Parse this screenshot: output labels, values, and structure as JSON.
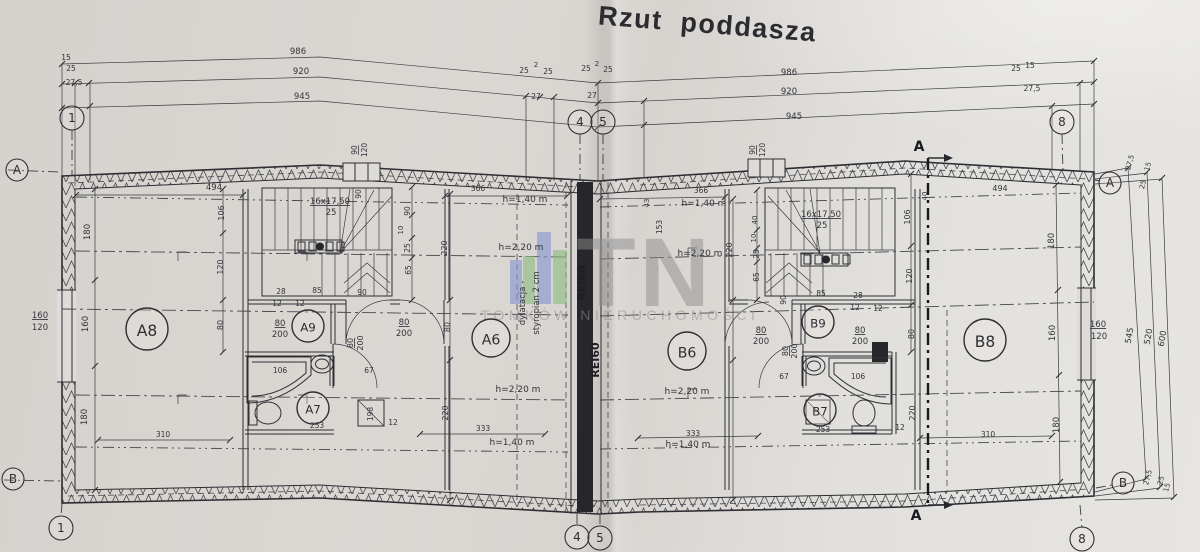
{
  "title": "Rzut poddasza",
  "watermark": {
    "brand": "TN",
    "subtitle": "TOMKÓW NIERUCHOMOŚCI",
    "color": "#8f8f8f",
    "bars": [
      {
        "x": 510,
        "y": 260,
        "w": 12,
        "h": 44,
        "c": "#8494ce"
      },
      {
        "x": 523,
        "y": 256,
        "w": 12,
        "h": 48,
        "c": "#8cbc80"
      },
      {
        "x": 537,
        "y": 232,
        "w": 14,
        "h": 72,
        "c": "#8494ce"
      },
      {
        "x": 553,
        "y": 250,
        "w": 14,
        "h": 54,
        "c": "#8cbc80"
      }
    ]
  },
  "rooms": [
    {
      "label": "A8",
      "x": 147,
      "y": 329,
      "r": 21
    },
    {
      "label": "A9",
      "x": 308,
      "y": 326,
      "r": 16
    },
    {
      "label": "A7",
      "x": 313,
      "y": 408,
      "r": 16
    },
    {
      "label": "A6",
      "x": 491,
      "y": 338,
      "r": 19
    },
    {
      "label": "B6",
      "x": 687,
      "y": 351,
      "r": 19
    },
    {
      "label": "B9",
      "x": 818,
      "y": 322,
      "r": 16
    },
    {
      "label": "B7",
      "x": 820,
      "y": 410,
      "r": 16
    },
    {
      "label": "B8",
      "x": 985,
      "y": 340,
      "r": 21
    }
  ],
  "axis_markers": [
    {
      "label": "1",
      "x": 72,
      "y": 118,
      "r": 12
    },
    {
      "label": "4",
      "x": 580,
      "y": 122,
      "r": 12
    },
    {
      "label": "5",
      "x": 603,
      "y": 122,
      "r": 12
    },
    {
      "label": "8",
      "x": 1062,
      "y": 122,
      "r": 12
    },
    {
      "label": "1",
      "x": 61,
      "y": 528,
      "r": 12
    },
    {
      "label": "4",
      "x": 577,
      "y": 537,
      "r": 12
    },
    {
      "label": "5",
      "x": 600,
      "y": 538,
      "r": 12
    },
    {
      "label": "8",
      "x": 1082,
      "y": 539,
      "r": 12
    },
    {
      "label": "A",
      "x": 17,
      "y": 170,
      "r": 11
    },
    {
      "label": "B",
      "x": 13,
      "y": 479,
      "r": 11
    },
    {
      "label": "A",
      "x": 1110,
      "y": 183,
      "r": 11
    },
    {
      "label": "B",
      "x": 1123,
      "y": 483,
      "r": 11
    }
  ],
  "section_markers": [
    {
      "label": "A",
      "x": 919,
      "y": 151
    },
    {
      "label": "A",
      "x": 916,
      "y": 520
    }
  ],
  "annotations": [
    {
      "t": "986",
      "x": 298,
      "y": 54
    },
    {
      "t": "15",
      "x": 66,
      "y": 60,
      "s": 7.5
    },
    {
      "t": "25",
      "x": 71,
      "y": 71,
      "s": 7.5
    },
    {
      "t": "920",
      "x": 301,
      "y": 74
    },
    {
      "t": "25",
      "x": 524,
      "y": 73,
      "s": 7.5
    },
    {
      "t": "2",
      "x": 536,
      "y": 67,
      "s": 7
    },
    {
      "t": "25",
      "x": 548,
      "y": 74,
      "s": 7.5
    },
    {
      "t": "27,5",
      "x": 74,
      "y": 85,
      "s": 7.5
    },
    {
      "t": "945",
      "x": 302,
      "y": 99
    },
    {
      "t": "27",
      "x": 536,
      "y": 99,
      "s": 7.5
    },
    {
      "t": "25",
      "x": 586,
      "y": 71,
      "s": 7.5
    },
    {
      "t": "2",
      "x": 597,
      "y": 66,
      "s": 7
    },
    {
      "t": "25",
      "x": 608,
      "y": 72,
      "s": 7.5
    },
    {
      "t": "27",
      "x": 592,
      "y": 98,
      "s": 7.5
    },
    {
      "t": "986",
      "x": 789,
      "y": 75
    },
    {
      "t": "920",
      "x": 789,
      "y": 94
    },
    {
      "t": "945",
      "x": 794,
      "y": 119
    },
    {
      "t": "25",
      "x": 1016,
      "y": 71,
      "s": 7.5
    },
    {
      "t": "15",
      "x": 1030,
      "y": 68,
      "s": 7.5
    },
    {
      "t": "27,5",
      "x": 1032,
      "y": 91,
      "s": 7.5
    },
    {
      "t": "160",
      "x": 40,
      "y": 318,
      "s": 8.5,
      "u": 1
    },
    {
      "t": "120",
      "x": 40,
      "y": 330,
      "s": 8.5
    },
    {
      "t": "180",
      "x": 90,
      "y": 232,
      "r": -90
    },
    {
      "t": "160",
      "x": 88,
      "y": 324,
      "r": -90
    },
    {
      "t": "180",
      "x": 87,
      "y": 417,
      "r": -90
    },
    {
      "t": "494",
      "x": 214,
      "y": 190
    },
    {
      "t": "106",
      "x": 224,
      "y": 213,
      "r": -90,
      "s": 8
    },
    {
      "t": "120",
      "x": 223,
      "y": 267,
      "r": -90,
      "s": 8
    },
    {
      "t": "80",
      "x": 223,
      "y": 325,
      "r": -90,
      "s": 8
    },
    {
      "t": "16x17,50",
      "x": 330,
      "y": 204,
      "s": 8.5,
      "u": 1
    },
    {
      "t": "25",
      "x": 331,
      "y": 215,
      "s": 8.5
    },
    {
      "t": "90",
      "x": 357,
      "y": 150,
      "r": -90,
      "s": 7.5,
      "u": 1
    },
    {
      "t": "120",
      "x": 367,
      "y": 150,
      "r": -90,
      "s": 7.5
    },
    {
      "t": "90",
      "x": 361,
      "y": 194,
      "r": -90,
      "s": 7.5
    },
    {
      "t": "90",
      "x": 410,
      "y": 211,
      "r": -90,
      "s": 7.5
    },
    {
      "t": "10",
      "x": 403,
      "y": 230,
      "r": -90,
      "s": 7
    },
    {
      "t": "25",
      "x": 410,
      "y": 248,
      "r": -90,
      "s": 7.5
    },
    {
      "t": "65",
      "x": 411,
      "y": 270,
      "r": -90,
      "s": 7.5
    },
    {
      "t": "220",
      "x": 447,
      "y": 248,
      "r": -90,
      "s": 8
    },
    {
      "t": "28",
      "x": 281,
      "y": 294,
      "s": 7.5
    },
    {
      "t": "85",
      "x": 317,
      "y": 293,
      "s": 7.5
    },
    {
      "t": "90",
      "x": 362,
      "y": 295,
      "s": 7.5
    },
    {
      "t": "12",
      "x": 277,
      "y": 306,
      "s": 7.5
    },
    {
      "t": "12",
      "x": 300,
      "y": 306,
      "s": 7.5
    },
    {
      "t": "80",
      "x": 280,
      "y": 326,
      "s": 8.5,
      "u": 1
    },
    {
      "t": "200",
      "x": 280,
      "y": 337,
      "s": 8.5
    },
    {
      "t": "80",
      "x": 404,
      "y": 325,
      "s": 8.5,
      "u": 1
    },
    {
      "t": "200",
      "x": 404,
      "y": 336,
      "s": 8.5
    },
    {
      "t": "80",
      "x": 353,
      "y": 343,
      "r": -90,
      "s": 8,
      "u": 1
    },
    {
      "t": "200",
      "x": 363,
      "y": 343,
      "r": -90,
      "s": 8
    },
    {
      "t": "106",
      "x": 280,
      "y": 373,
      "s": 7.5
    },
    {
      "t": "67",
      "x": 369,
      "y": 373,
      "s": 7.5
    },
    {
      "t": "253",
      "x": 317,
      "y": 428,
      "s": 7.5
    },
    {
      "t": "198",
      "x": 373,
      "y": 414,
      "r": -90,
      "s": 7.5
    },
    {
      "t": "12",
      "x": 393,
      "y": 425,
      "s": 7.5
    },
    {
      "t": "220",
      "x": 448,
      "y": 413,
      "r": -90,
      "s": 8
    },
    {
      "t": "310",
      "x": 163,
      "y": 437,
      "s": 7.5
    },
    {
      "t": "366",
      "x": 478,
      "y": 191,
      "s": 7.5
    },
    {
      "t": "h=1,40 m",
      "x": 525,
      "y": 202,
      "s": 9
    },
    {
      "t": "h=2,20 m",
      "x": 521,
      "y": 250,
      "s": 9
    },
    {
      "t": "80",
      "x": 450,
      "y": 327,
      "r": -90,
      "s": 8
    },
    {
      "t": "h=2,20 m",
      "x": 518,
      "y": 392,
      "s": 9
    },
    {
      "t": "333",
      "x": 483,
      "y": 431,
      "s": 7.5
    },
    {
      "t": "h=1,40 m",
      "x": 512,
      "y": 445,
      "s": 9
    },
    {
      "t": "dylatacja -",
      "x": 525,
      "y": 303,
      "r": -90,
      "s": 8.5
    },
    {
      "t": "styropian 2 cm",
      "x": 539,
      "y": 303,
      "r": -90,
      "s": 8.5
    },
    {
      "t": "REI60",
      "x": 585,
      "y": 283,
      "r": -90,
      "s": 11,
      "b": 1
    },
    {
      "t": "REI60",
      "x": 599,
      "y": 360,
      "r": -90,
      "s": 11,
      "b": 1
    },
    {
      "t": "366",
      "x": 701,
      "y": 193,
      "s": 7.5
    },
    {
      "t": "43",
      "x": 649,
      "y": 203,
      "r": -90,
      "s": 7
    },
    {
      "t": "h=1,40 m",
      "x": 704,
      "y": 206,
      "s": 9
    },
    {
      "t": "153",
      "x": 662,
      "y": 227,
      "r": -90,
      "s": 7.5
    },
    {
      "t": "h=2,20 m",
      "x": 700,
      "y": 256,
      "s": 9
    },
    {
      "t": "220",
      "x": 732,
      "y": 250,
      "r": -90,
      "s": 8
    },
    {
      "t": "40",
      "x": 757,
      "y": 220,
      "r": -90,
      "s": 7
    },
    {
      "t": "10",
      "x": 756,
      "y": 238,
      "r": -90,
      "s": 7
    },
    {
      "t": "25",
      "x": 759,
      "y": 254,
      "r": -90,
      "s": 7.5
    },
    {
      "t": "65",
      "x": 759,
      "y": 277,
      "r": -90,
      "s": 7.5
    },
    {
      "t": "90",
      "x": 786,
      "y": 300,
      "r": -90,
      "s": 7.5
    },
    {
      "t": "16x17,50",
      "x": 821,
      "y": 217,
      "s": 8.5,
      "u": 1
    },
    {
      "t": "25",
      "x": 822,
      "y": 228,
      "s": 8.5
    },
    {
      "t": "90",
      "x": 755,
      "y": 150,
      "r": -90,
      "s": 7.5,
      "u": 1
    },
    {
      "t": "120",
      "x": 765,
      "y": 150,
      "r": -90,
      "s": 7.5
    },
    {
      "t": "85",
      "x": 821,
      "y": 296,
      "s": 7.5
    },
    {
      "t": "28",
      "x": 858,
      "y": 298,
      "s": 7.5
    },
    {
      "t": "12",
      "x": 855,
      "y": 310,
      "s": 7.5
    },
    {
      "t": "12",
      "x": 878,
      "y": 311,
      "s": 7.5
    },
    {
      "t": "80",
      "x": 860,
      "y": 333,
      "s": 8.5,
      "u": 1
    },
    {
      "t": "200",
      "x": 860,
      "y": 344,
      "s": 8.5
    },
    {
      "t": "80",
      "x": 761,
      "y": 333,
      "s": 8.5,
      "u": 1
    },
    {
      "t": "200",
      "x": 761,
      "y": 344,
      "s": 8.5
    },
    {
      "t": "80",
      "x": 788,
      "y": 351,
      "r": -90,
      "s": 8,
      "u": 1
    },
    {
      "t": "200",
      "x": 797,
      "y": 351,
      "r": -90,
      "s": 8
    },
    {
      "t": "67",
      "x": 784,
      "y": 379,
      "s": 7.5
    },
    {
      "t": "106",
      "x": 858,
      "y": 379,
      "s": 7.5
    },
    {
      "t": "253",
      "x": 823,
      "y": 432,
      "s": 7.5
    },
    {
      "t": "12",
      "x": 900,
      "y": 430,
      "s": 7.5
    },
    {
      "t": "220",
      "x": 915,
      "y": 413,
      "r": -90,
      "s": 8
    },
    {
      "t": "310",
      "x": 988,
      "y": 437,
      "s": 7.5
    },
    {
      "t": "333",
      "x": 693,
      "y": 436,
      "s": 7.5
    },
    {
      "t": "h=1,40 m",
      "x": 688,
      "y": 447,
      "s": 9
    },
    {
      "t": "h=2,20 m",
      "x": 687,
      "y": 394,
      "s": 9
    },
    {
      "t": "106",
      "x": 910,
      "y": 217,
      "r": -90,
      "s": 8
    },
    {
      "t": "120",
      "x": 912,
      "y": 276,
      "r": -90,
      "s": 8
    },
    {
      "t": "80",
      "x": 914,
      "y": 334,
      "r": -90,
      "s": 8
    },
    {
      "t": "40",
      "x": 927,
      "y": 196,
      "r": -90,
      "s": 7
    },
    {
      "t": "494",
      "x": 1000,
      "y": 191,
      "s": 8
    },
    {
      "t": "180",
      "x": 1054,
      "y": 241,
      "r": -90
    },
    {
      "t": "160",
      "x": 1055,
      "y": 333,
      "r": -90
    },
    {
      "t": "180",
      "x": 1059,
      "y": 425,
      "r": -90
    },
    {
      "t": "160",
      "x": 1098,
      "y": 327,
      "s": 8.5,
      "u": 1
    },
    {
      "t": "120",
      "x": 1099,
      "y": 339,
      "s": 8.5
    },
    {
      "t": "27,5",
      "x": 1132,
      "y": 163,
      "r": -75,
      "s": 7
    },
    {
      "t": "15",
      "x": 1150,
      "y": 167,
      "r": -75,
      "s": 7
    },
    {
      "t": "25",
      "x": 1145,
      "y": 185,
      "r": -75,
      "s": 7
    },
    {
      "t": "545",
      "x": 1132,
      "y": 336,
      "r": -80
    },
    {
      "t": "520",
      "x": 1151,
      "y": 337,
      "r": -80
    },
    {
      "t": "600",
      "x": 1165,
      "y": 339,
      "r": -80
    },
    {
      "t": "27,5",
      "x": 1150,
      "y": 478,
      "r": -75,
      "s": 7
    },
    {
      "t": "25",
      "x": 1163,
      "y": 481,
      "r": -75,
      "s": 7
    },
    {
      "t": "15",
      "x": 1169,
      "y": 488,
      "r": -75,
      "s": 7
    }
  ]
}
